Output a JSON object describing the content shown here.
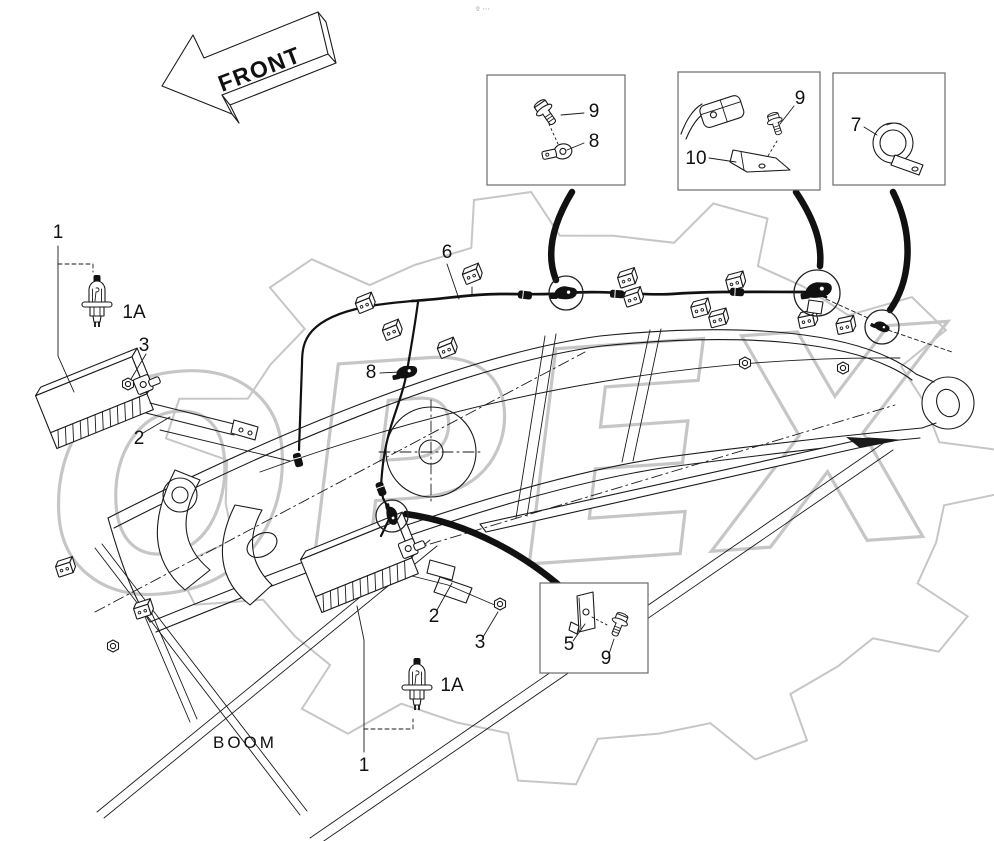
{
  "page": {
    "front_label": "FRONT",
    "boom_label": "BOOM",
    "watermark_text": "OPEX",
    "page_mark": "º ···"
  },
  "colors": {
    "ink": "#1a1a1a",
    "watermark_gray": "#c6c6c6",
    "detail_box_border": "#6a6a6a"
  },
  "callouts": [
    {
      "id": "work-light-upper",
      "text": "1",
      "x": 58,
      "y": 238
    },
    {
      "id": "bulb-upper",
      "text": "1A",
      "x": 134,
      "y": 318
    },
    {
      "id": "nut-upper",
      "text": "3",
      "x": 144,
      "y": 351
    },
    {
      "id": "bracket-upper",
      "text": "2",
      "x": 139,
      "y": 444
    },
    {
      "id": "wiring-harness",
      "text": "6",
      "x": 447,
      "y": 258
    },
    {
      "id": "clamp-mid",
      "text": "8",
      "x": 371,
      "y": 378
    },
    {
      "id": "bracket-lower",
      "text": "2",
      "x": 434,
      "y": 622
    },
    {
      "id": "nut-lower",
      "text": "3",
      "x": 480,
      "y": 648
    },
    {
      "id": "bulb-lower",
      "text": "1A",
      "x": 452,
      "y": 691
    },
    {
      "id": "work-light-lower",
      "text": "1",
      "x": 364,
      "y": 771
    },
    {
      "id": "box1-bolt",
      "text": "9",
      "x": 594,
      "y": 117
    },
    {
      "id": "box1-clamp",
      "text": "8",
      "x": 594,
      "y": 147
    },
    {
      "id": "box2-bolt",
      "text": "9",
      "x": 800,
      "y": 104
    },
    {
      "id": "box2-bracket",
      "text": "10",
      "x": 696,
      "y": 164
    },
    {
      "id": "box3-p-clamp",
      "text": "7",
      "x": 856,
      "y": 131
    },
    {
      "id": "box4-bracket",
      "text": "5",
      "x": 569,
      "y": 650
    },
    {
      "id": "box4-bolt",
      "text": "9",
      "x": 606,
      "y": 664
    }
  ]
}
